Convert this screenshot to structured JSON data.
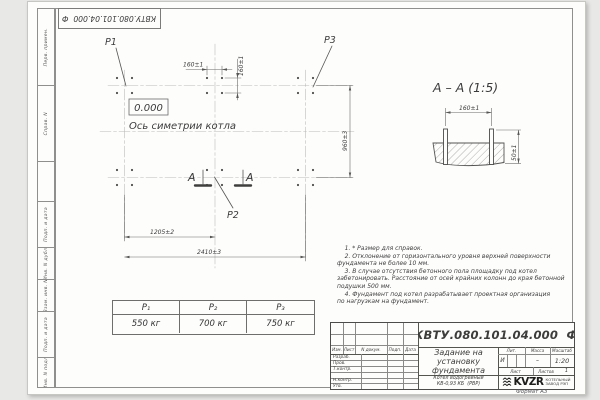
{
  "sheet": {
    "stamp_top": "КВТУ.080.101.04.000  Ф",
    "format_label": "Формат А3",
    "margin_labels": [
      "Перв. примен.",
      "Справ. N",
      "Подп. и дата",
      "Инв. N дубл.",
      "Взам. инв. N",
      "Подп. и дата",
      "Инв. N подл."
    ]
  },
  "plan": {
    "p1": "P1",
    "p2": "P2",
    "p3": "P3",
    "elevation": "0.000",
    "axis_label": "Ось симетрии котла",
    "dim_160_top": "160±1",
    "dim_160_side": "160±1",
    "dim_960": "960±3",
    "dim_1205": "1205±2",
    "dim_2410": "2410±3",
    "cut_letter_left": "А",
    "cut_letter_right": "А"
  },
  "section": {
    "title": "А – А (1:5)",
    "dim_160": "160±1",
    "dim_50": "50±1"
  },
  "notes": {
    "lines": [
      "    1. * Размер для справок.",
      "    2. Отклонение от горизонтального уровня верхней поверхности",
      "фундамента не более 10 мм.",
      "    3. В случае отсутствия бетонного пола площадку под котел",
      "забетонировать. Расстояние от осей крайних колонн до края бетонной",
      "подушки 500 мм.",
      "    4. Фундамент под котел разрабатывает проектная организация",
      "по нагрузкам на фундамент."
    ]
  },
  "load_table": {
    "headers": [
      "P₁",
      "P₂",
      "P₃"
    ],
    "values": [
      "550 кг",
      "700 кг",
      "750 кг"
    ]
  },
  "title_block": {
    "doc_number": "КВТУ.080.101.04.000  Ф",
    "title_lines": [
      "Задание на",
      "установку",
      "фундамента"
    ],
    "product_lines": [
      "Котел водогрейный",
      "КВ-0,93 КБ  (РВР)"
    ],
    "rev_cols": [
      "Изм.",
      "Лист",
      "N докум.",
      "Подп.",
      "Дата"
    ],
    "sig_rows": [
      "Разраб.",
      "Пров.",
      "Т.контр.",
      "",
      "Н.контр.",
      "Утв."
    ],
    "lit_label": "Лит.",
    "mass_label": "Масса",
    "scale_label": "Масштаб",
    "lit_value": "И",
    "mass_value": "–",
    "scale_value": "1:20",
    "sheet_label": "Лист",
    "sheets_label": "Листов",
    "sheets_value": "1",
    "logo_text": "KVZR",
    "logo_caption": [
      "КОТЕЛЬНЫЙ",
      "ЗАВОД РЭП"
    ]
  }
}
